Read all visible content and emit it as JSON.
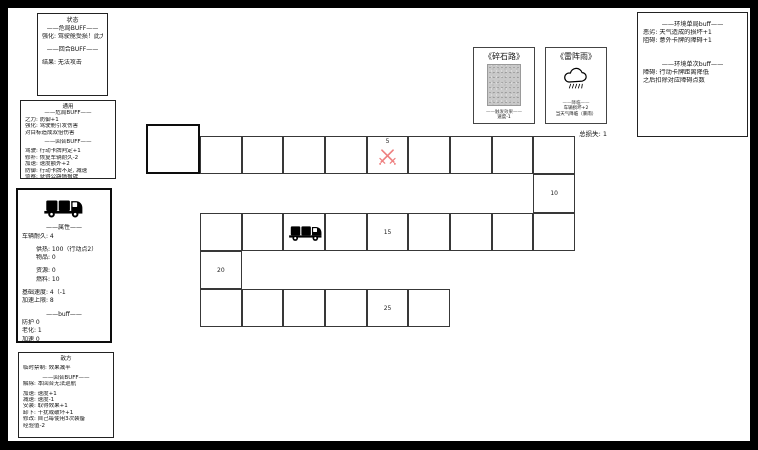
{
  "panels": {
    "status": {
      "title": "状态",
      "lines": [
        {
          "t": "——危局BUFF——",
          "c": 1
        },
        {
          "t": "强化: 驾驶舱受损！此大力"
        },
        {
          "t": ""
        },
        {
          "t": "——回合BUFF——",
          "c": 1
        },
        {
          "t": ""
        },
        {
          "t": "结果: 无法攻击"
        }
      ]
    },
    "common": {
      "title": "通用",
      "lines": [
        {
          "t": "——危局BUFF——",
          "c": 1
        },
        {
          "t": "之力: 防御+1"
        },
        {
          "t": "强化: 驾驶舱引发伤害"
        },
        {
          "t": "对目标造成双倍伤害"
        },
        {
          "t": ""
        },
        {
          "t": "——回合BUFF——",
          "c": 1
        },
        {
          "t": ""
        },
        {
          "t": "驾驶: 行动卡牌判定+1"
        },
        {
          "t": "修补: 恢复车辆耐久-2"
        },
        {
          "t": "加速: 速度额外+2"
        },
        {
          "t": "防御: 行动卡牌不足, 减速"
        },
        {
          "t": "侦察: 获得公路情报牌"
        }
      ]
    },
    "vehicle": {
      "lines": [
        {
          "t": "——属性——",
          "c": 1
        },
        {
          "t": "车辆耐久: 4"
        },
        {
          "t": ""
        },
        {
          "t": "供热: 100（行动点2）",
          "i": 1
        },
        {
          "t": "物品: 0",
          "i": 1
        },
        {
          "t": ""
        },
        {
          "t": "资源: 0",
          "i": 1
        },
        {
          "t": "燃料: 10",
          "i": 1
        },
        {
          "t": ""
        },
        {
          "t": "基础速度: 4（-1"
        },
        {
          "t": "加速上限: 8"
        },
        {
          "t": ""
        },
        {
          "t": "——buff——",
          "c": 1
        },
        {
          "t": "防护 0"
        },
        {
          "t": "老化: 1"
        },
        {
          "t": "加速 0"
        }
      ]
    },
    "enemy": {
      "title": "敌方",
      "lines": [
        {
          "t": ""
        },
        {
          "t": "临时禁制: 效果减半"
        },
        {
          "t": ""
        },
        {
          "t": "——回合BUFF——",
          "c": 1
        },
        {
          "t": "解除: 本回合无法巡航"
        },
        {
          "t": ""
        },
        {
          "t": "加速: 速度+1"
        },
        {
          "t": "减速: 速度-1"
        },
        {
          "t": "安装: 取得效果+1"
        },
        {
          "t": "卸下: 干扰或破坏+1"
        },
        {
          "t": "修改: 自己每使用3次装备"
        },
        {
          "t": "经验值-2"
        }
      ]
    }
  },
  "cards": [
    {
      "title": "《碎石路》",
      "image": "gravel-texture",
      "separator": "——触发效果——",
      "effects": [
        "速度-1"
      ]
    },
    {
      "title": "《雷阵雨》",
      "image": "storm-cloud-icon",
      "separator": "——降临——",
      "effects": [
        "车辆损坏+2",
        "当天气降临（暴雨）"
      ]
    }
  ],
  "score_label": "总损失: 1",
  "environment": {
    "sections": [
      {
        "header": "——环境单局buff——",
        "lines": [
          "恶劣: 天气造成的损坏+1",
          "阻碍: 意外卡牌的障碍+1"
        ]
      },
      {
        "header": "——环境单次buff——",
        "lines": [
          "障碍: 行动卡牌距离降低",
          "之后扣除对应障碍点数"
        ]
      }
    ]
  },
  "colors": {
    "sword_icon": "#ee8080",
    "track_border": "#383838"
  },
  "track": {
    "numbers": [
      "5",
      "10",
      "15",
      "20",
      "25"
    ],
    "cells": [
      {
        "x": 138,
        "y": 116,
        "w": 54,
        "h": 50,
        "type": "start"
      },
      {
        "x": 192,
        "y": 127.5
      },
      {
        "x": 233.7,
        "y": 127.5
      },
      {
        "x": 275.3,
        "y": 127.5
      },
      {
        "x": 317,
        "y": 127.5
      },
      {
        "x": 358.7,
        "y": 127.5,
        "num": "5",
        "icon": "swords"
      },
      {
        "x": 400.3,
        "y": 127.5
      },
      {
        "x": 442,
        "y": 127.5
      },
      {
        "x": 483.7,
        "y": 127.5
      },
      {
        "x": 525.3,
        "y": 127.5
      },
      {
        "x": 525.3,
        "y": 166,
        "h": 39,
        "num": "10"
      },
      {
        "x": 192,
        "y": 205,
        "h": 38
      },
      {
        "x": 233.7,
        "y": 205,
        "h": 38
      },
      {
        "x": 275.3,
        "y": 205,
        "h": 38,
        "icon": "truck"
      },
      {
        "x": 317,
        "y": 205,
        "h": 38
      },
      {
        "x": 358.7,
        "y": 205,
        "h": 38,
        "num": "15"
      },
      {
        "x": 400.3,
        "y": 205,
        "h": 38
      },
      {
        "x": 442,
        "y": 205,
        "h": 38
      },
      {
        "x": 483.7,
        "y": 205,
        "h": 38
      },
      {
        "x": 525.3,
        "y": 205,
        "h": 38
      },
      {
        "x": 192,
        "y": 243,
        "h": 38,
        "num": "20"
      },
      {
        "x": 192,
        "y": 281,
        "h": 38
      },
      {
        "x": 233.7,
        "y": 281,
        "h": 38
      },
      {
        "x": 275.3,
        "y": 281,
        "h": 38
      },
      {
        "x": 317,
        "y": 281,
        "h": 38
      },
      {
        "x": 358.7,
        "y": 281,
        "h": 38,
        "num": "25"
      },
      {
        "x": 400.3,
        "y": 281,
        "h": 38
      }
    ]
  }
}
